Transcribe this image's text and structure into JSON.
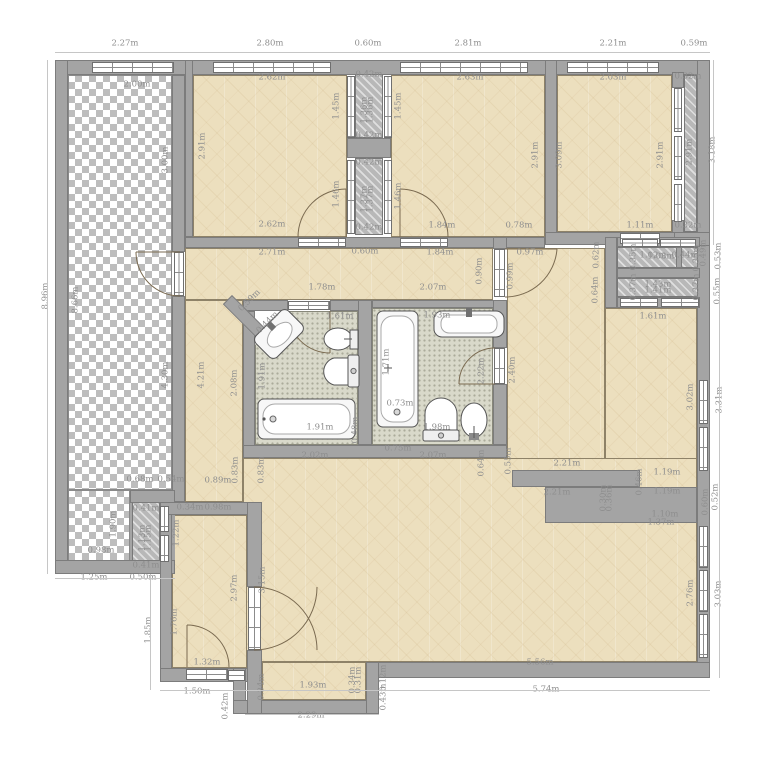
{
  "plan": {
    "type": "apartment-floor-plan",
    "units": "m",
    "colors": {
      "wall": "#a4a4a4",
      "room_floor": "#ecdfbe",
      "bath_floor": "#d9d9ca",
      "terrace_check": "#bdbdbd",
      "dim_text": "#8e8e8e",
      "door_arc": "#7a6a50"
    },
    "dim_labels": [
      {
        "t": "2.27m",
        "x": 125,
        "y": 44,
        "r": 0
      },
      {
        "t": "2.80m",
        "x": 270,
        "y": 44,
        "r": 0
      },
      {
        "t": "0.60m",
        "x": 368,
        "y": 44,
        "r": 0
      },
      {
        "t": "2.81m",
        "x": 468,
        "y": 44,
        "r": 0
      },
      {
        "t": "2.21m",
        "x": 613,
        "y": 44,
        "r": 0
      },
      {
        "t": "0.59m",
        "x": 694,
        "y": 44,
        "r": 0
      },
      {
        "t": "8.96m",
        "x": 46,
        "y": 296,
        "r": 90
      },
      {
        "t": "3.18m",
        "x": 713,
        "y": 150,
        "r": 90
      },
      {
        "t": "0.49m",
        "x": 704,
        "y": 253,
        "r": 90
      },
      {
        "t": "0.53m",
        "x": 719,
        "y": 256,
        "r": 90
      },
      {
        "t": "0.55m",
        "x": 718,
        "y": 291,
        "r": 90
      },
      {
        "t": "3.31m",
        "x": 720,
        "y": 400,
        "r": 90
      },
      {
        "t": "0.52m",
        "x": 716,
        "y": 497,
        "r": 90
      },
      {
        "t": "0.60m",
        "x": 706,
        "y": 502,
        "r": 90
      },
      {
        "t": "3.03m",
        "x": 719,
        "y": 594,
        "r": 90
      },
      {
        "t": "5.74m",
        "x": 546,
        "y": 690,
        "r": 0
      },
      {
        "t": "5.56m",
        "x": 540,
        "y": 663,
        "r": 0
      },
      {
        "t": "1.25m",
        "x": 94,
        "y": 578,
        "r": 0
      },
      {
        "t": "0.50m",
        "x": 143,
        "y": 578,
        "r": 0
      },
      {
        "t": "1.85m",
        "x": 149,
        "y": 630,
        "r": 90
      },
      {
        "t": "1.50m",
        "x": 197,
        "y": 692,
        "r": 0
      },
      {
        "t": "0.42m",
        "x": 226,
        "y": 706,
        "r": 90
      },
      {
        "t": "2.29m",
        "x": 311,
        "y": 716,
        "r": 0
      },
      {
        "t": "0.43m",
        "x": 384,
        "y": 697,
        "r": 90
      },
      {
        "t": "0.12m",
        "x": 384,
        "y": 678,
        "r": 90
      },
      {
        "t": "2.00m",
        "x": 137,
        "y": 85,
        "r": 0
      },
      {
        "t": "3.00m",
        "x": 166,
        "y": 160,
        "r": 90
      },
      {
        "t": "8.66m",
        "x": 76,
        "y": 300,
        "r": 90
      },
      {
        "t": "4.30m",
        "x": 166,
        "y": 375,
        "r": 90
      },
      {
        "t": "1.90m",
        "x": 114,
        "y": 524,
        "r": 90
      },
      {
        "t": "0.98m",
        "x": 101,
        "y": 551,
        "r": 0
      },
      {
        "t": "0.68m",
        "x": 140,
        "y": 480,
        "r": 0
      },
      {
        "t": "0.54m",
        "x": 171,
        "y": 480,
        "r": 0
      },
      {
        "t": "2.62m",
        "x": 272,
        "y": 78,
        "r": 0
      },
      {
        "t": "2.91m",
        "x": 203,
        "y": 146,
        "r": 90
      },
      {
        "t": "1.45m",
        "x": 337,
        "y": 106,
        "r": 90
      },
      {
        "t": "1.46m",
        "x": 337,
        "y": 194,
        "r": 90
      },
      {
        "t": "2.62m",
        "x": 272,
        "y": 225,
        "r": 0
      },
      {
        "t": "0.42m",
        "x": 369,
        "y": 75,
        "r": 0
      },
      {
        "t": "1.36m",
        "x": 365,
        "y": 110,
        "r": 90
      },
      {
        "t": "1.36m",
        "x": 371,
        "y": 110,
        "r": 90
      },
      {
        "t": "0.42m",
        "x": 369,
        "y": 136,
        "r": 0
      },
      {
        "t": "0.42m",
        "x": 369,
        "y": 163,
        "r": 0
      },
      {
        "t": "1.37m",
        "x": 365,
        "y": 199,
        "r": 90
      },
      {
        "t": "1.37m",
        "x": 371,
        "y": 199,
        "r": 90
      },
      {
        "t": "0.42m",
        "x": 369,
        "y": 228,
        "r": 0
      },
      {
        "t": "2.63m",
        "x": 470,
        "y": 78,
        "r": 0
      },
      {
        "t": "1.45m",
        "x": 399,
        "y": 106,
        "r": 90
      },
      {
        "t": "1.46m",
        "x": 399,
        "y": 196,
        "r": 90
      },
      {
        "t": "2.91m",
        "x": 536,
        "y": 155,
        "r": 90
      },
      {
        "t": "1.84m",
        "x": 442,
        "y": 226,
        "r": 0
      },
      {
        "t": "0.78m",
        "x": 519,
        "y": 226,
        "r": 0
      },
      {
        "t": "2.03m",
        "x": 613,
        "y": 78,
        "r": 0
      },
      {
        "t": "3.09m",
        "x": 560,
        "y": 155,
        "r": 90
      },
      {
        "t": "2.91m",
        "x": 661,
        "y": 155,
        "r": 90
      },
      {
        "t": "1.11m",
        "x": 640,
        "y": 226,
        "r": 0
      },
      {
        "t": "0.32m",
        "x": 688,
        "y": 77,
        "r": 0
      },
      {
        "t": "2.91m",
        "x": 690,
        "y": 152,
        "r": 90
      },
      {
        "t": "0.32m",
        "x": 688,
        "y": 226,
        "r": 0
      },
      {
        "t": "2.71m",
        "x": 272,
        "y": 253,
        "r": 0
      },
      {
        "t": "0.60m",
        "x": 365,
        "y": 252,
        "r": 0
      },
      {
        "t": "1.84m",
        "x": 440,
        "y": 253,
        "r": 0
      },
      {
        "t": "0.97m",
        "x": 530,
        "y": 253,
        "r": 0
      },
      {
        "t": "1.78m",
        "x": 322,
        "y": 288,
        "r": 0
      },
      {
        "t": "2.07m",
        "x": 433,
        "y": 288,
        "r": 0
      },
      {
        "t": "0.90m",
        "x": 480,
        "y": 271,
        "r": 90
      },
      {
        "t": "0.99m",
        "x": 511,
        "y": 276,
        "r": 90
      },
      {
        "t": "0.59m",
        "x": 250,
        "y": 301,
        "r": 45
      },
      {
        "t": "0.44m",
        "x": 268,
        "y": 323,
        "r": 45
      },
      {
        "t": "4.21m",
        "x": 202,
        "y": 375,
        "r": 90
      },
      {
        "t": "2.08m",
        "x": 235,
        "y": 383,
        "r": 90
      },
      {
        "t": "0.89m",
        "x": 218,
        "y": 481,
        "r": 0
      },
      {
        "t": "0.83m",
        "x": 236,
        "y": 470,
        "r": 90
      },
      {
        "t": "0.83m",
        "x": 262,
        "y": 470,
        "r": 90
      },
      {
        "t": "0.62m",
        "x": 597,
        "y": 255,
        "r": 90
      },
      {
        "t": "0.64m",
        "x": 596,
        "y": 290,
        "r": 90
      },
      {
        "t": "1.61m",
        "x": 653,
        "y": 317,
        "r": 0
      },
      {
        "t": "2.40m",
        "x": 513,
        "y": 370,
        "r": 90
      },
      {
        "t": "3.02m",
        "x": 691,
        "y": 397,
        "r": 90
      },
      {
        "t": "0.35m",
        "x": 634,
        "y": 257,
        "r": 90
      },
      {
        "t": "1.02m",
        "x": 653,
        "y": 256,
        "r": 0
      },
      {
        "t": "1.03m",
        "x": 661,
        "y": 257,
        "r": 0
      },
      {
        "t": "0.44m",
        "x": 685,
        "y": 256,
        "r": 0
      },
      {
        "t": "0.35m",
        "x": 697,
        "y": 258,
        "r": 90
      },
      {
        "t": "0.37m",
        "x": 634,
        "y": 287,
        "r": 90
      },
      {
        "t": "1.43m",
        "x": 658,
        "y": 285,
        "r": 0
      },
      {
        "t": "1.41m",
        "x": 658,
        "y": 291,
        "r": 0
      },
      {
        "t": "0.37m",
        "x": 697,
        "y": 287,
        "r": 90
      },
      {
        "t": "1.61m",
        "x": 340,
        "y": 317,
        "r": 0
      },
      {
        "t": "1.91m",
        "x": 263,
        "y": 376,
        "r": 90
      },
      {
        "t": "1.91m",
        "x": 320,
        "y": 428,
        "r": 0
      },
      {
        "t": "0.48m",
        "x": 356,
        "y": 430,
        "r": 90
      },
      {
        "t": "1.93m",
        "x": 437,
        "y": 316,
        "r": 0
      },
      {
        "t": "1.71m",
        "x": 387,
        "y": 362,
        "r": 90
      },
      {
        "t": "0.73m",
        "x": 400,
        "y": 404,
        "r": 0
      },
      {
        "t": "1.98m",
        "x": 437,
        "y": 428,
        "r": 0
      },
      {
        "t": "2.22m",
        "x": 482,
        "y": 371,
        "r": 90
      },
      {
        "t": "0.75m",
        "x": 398,
        "y": 449,
        "r": 0
      },
      {
        "t": "2.02m",
        "x": 315,
        "y": 456,
        "r": 0
      },
      {
        "t": "2.07m",
        "x": 433,
        "y": 456,
        "r": 0
      },
      {
        "t": "0.64m",
        "x": 482,
        "y": 463,
        "r": 90
      },
      {
        "t": "0.55m",
        "x": 509,
        "y": 461,
        "r": 90
      },
      {
        "t": "2.21m",
        "x": 567,
        "y": 464,
        "r": 0
      },
      {
        "t": "2.21m",
        "x": 557,
        "y": 493,
        "r": 0
      },
      {
        "t": "1.19m",
        "x": 667,
        "y": 473,
        "r": 0
      },
      {
        "t": "1.19m",
        "x": 667,
        "y": 492,
        "r": 0
      },
      {
        "t": "0.46m",
        "x": 640,
        "y": 482,
        "r": 90
      },
      {
        "t": "0.36m",
        "x": 610,
        "y": 498,
        "r": 90
      },
      {
        "t": "0.30m",
        "x": 604,
        "y": 498,
        "r": 90
      },
      {
        "t": "1.37m",
        "x": 661,
        "y": 523,
        "r": 0
      },
      {
        "t": "1.10m",
        "x": 665,
        "y": 515,
        "r": 0
      },
      {
        "t": "2.76m",
        "x": 691,
        "y": 593,
        "r": 90
      },
      {
        "t": "0.34m",
        "x": 190,
        "y": 508,
        "r": 0
      },
      {
        "t": "0.98m",
        "x": 218,
        "y": 508,
        "r": 0
      },
      {
        "t": "1.22m",
        "x": 177,
        "y": 533,
        "r": 90
      },
      {
        "t": "2.97m",
        "x": 235,
        "y": 588,
        "r": 90
      },
      {
        "t": "3.15m",
        "x": 263,
        "y": 580,
        "r": 90
      },
      {
        "t": "1.76m",
        "x": 175,
        "y": 622,
        "r": 90
      },
      {
        "t": "1.32m",
        "x": 207,
        "y": 663,
        "r": 0
      },
      {
        "t": "1.93m",
        "x": 313,
        "y": 686,
        "r": 0
      },
      {
        "t": "0.34m",
        "x": 262,
        "y": 687,
        "r": 90
      },
      {
        "t": "0.34m",
        "x": 353,
        "y": 680,
        "r": 90
      },
      {
        "t": "0.31m",
        "x": 359,
        "y": 680,
        "r": 90
      },
      {
        "t": "0.41m",
        "x": 146,
        "y": 509,
        "r": 0
      },
      {
        "t": "1.13m",
        "x": 143,
        "y": 538,
        "r": 90
      },
      {
        "t": "1.15m",
        "x": 149,
        "y": 538,
        "r": 90
      },
      {
        "t": "0.41m",
        "x": 146,
        "y": 566,
        "r": 0
      }
    ]
  }
}
